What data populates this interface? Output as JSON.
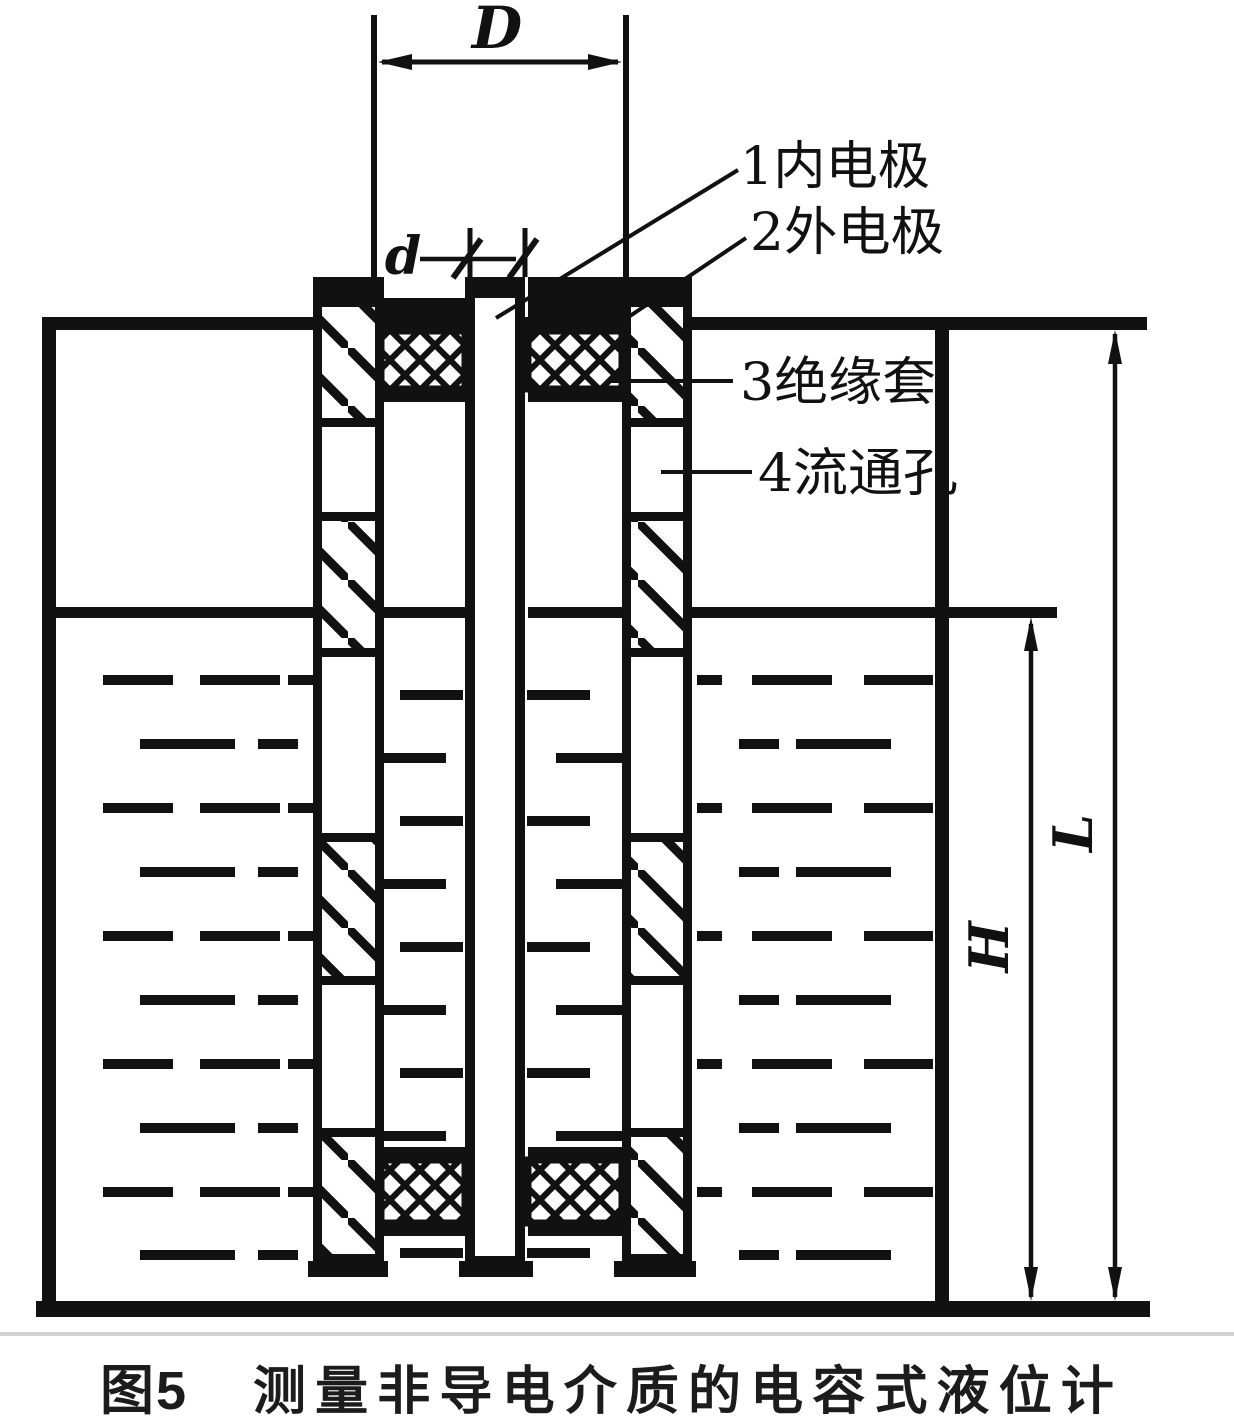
{
  "title_block": {
    "caption_prefix": "图5",
    "caption_title": "测量非导电介质的电容式液位计"
  },
  "dimension_labels": {
    "outer_diameter": "D",
    "rod_diameter": "d",
    "liquid_height": "H",
    "total_length": "L"
  },
  "part_labels": [
    {
      "label": "1内电极"
    },
    {
      "label": "2外电极"
    },
    {
      "label": "3绝缘套"
    },
    {
      "label": "4流通孔"
    }
  ],
  "colors": {
    "ink": "#111111",
    "paper": "#ffffff",
    "scan_line": "#c9c9c9"
  }
}
